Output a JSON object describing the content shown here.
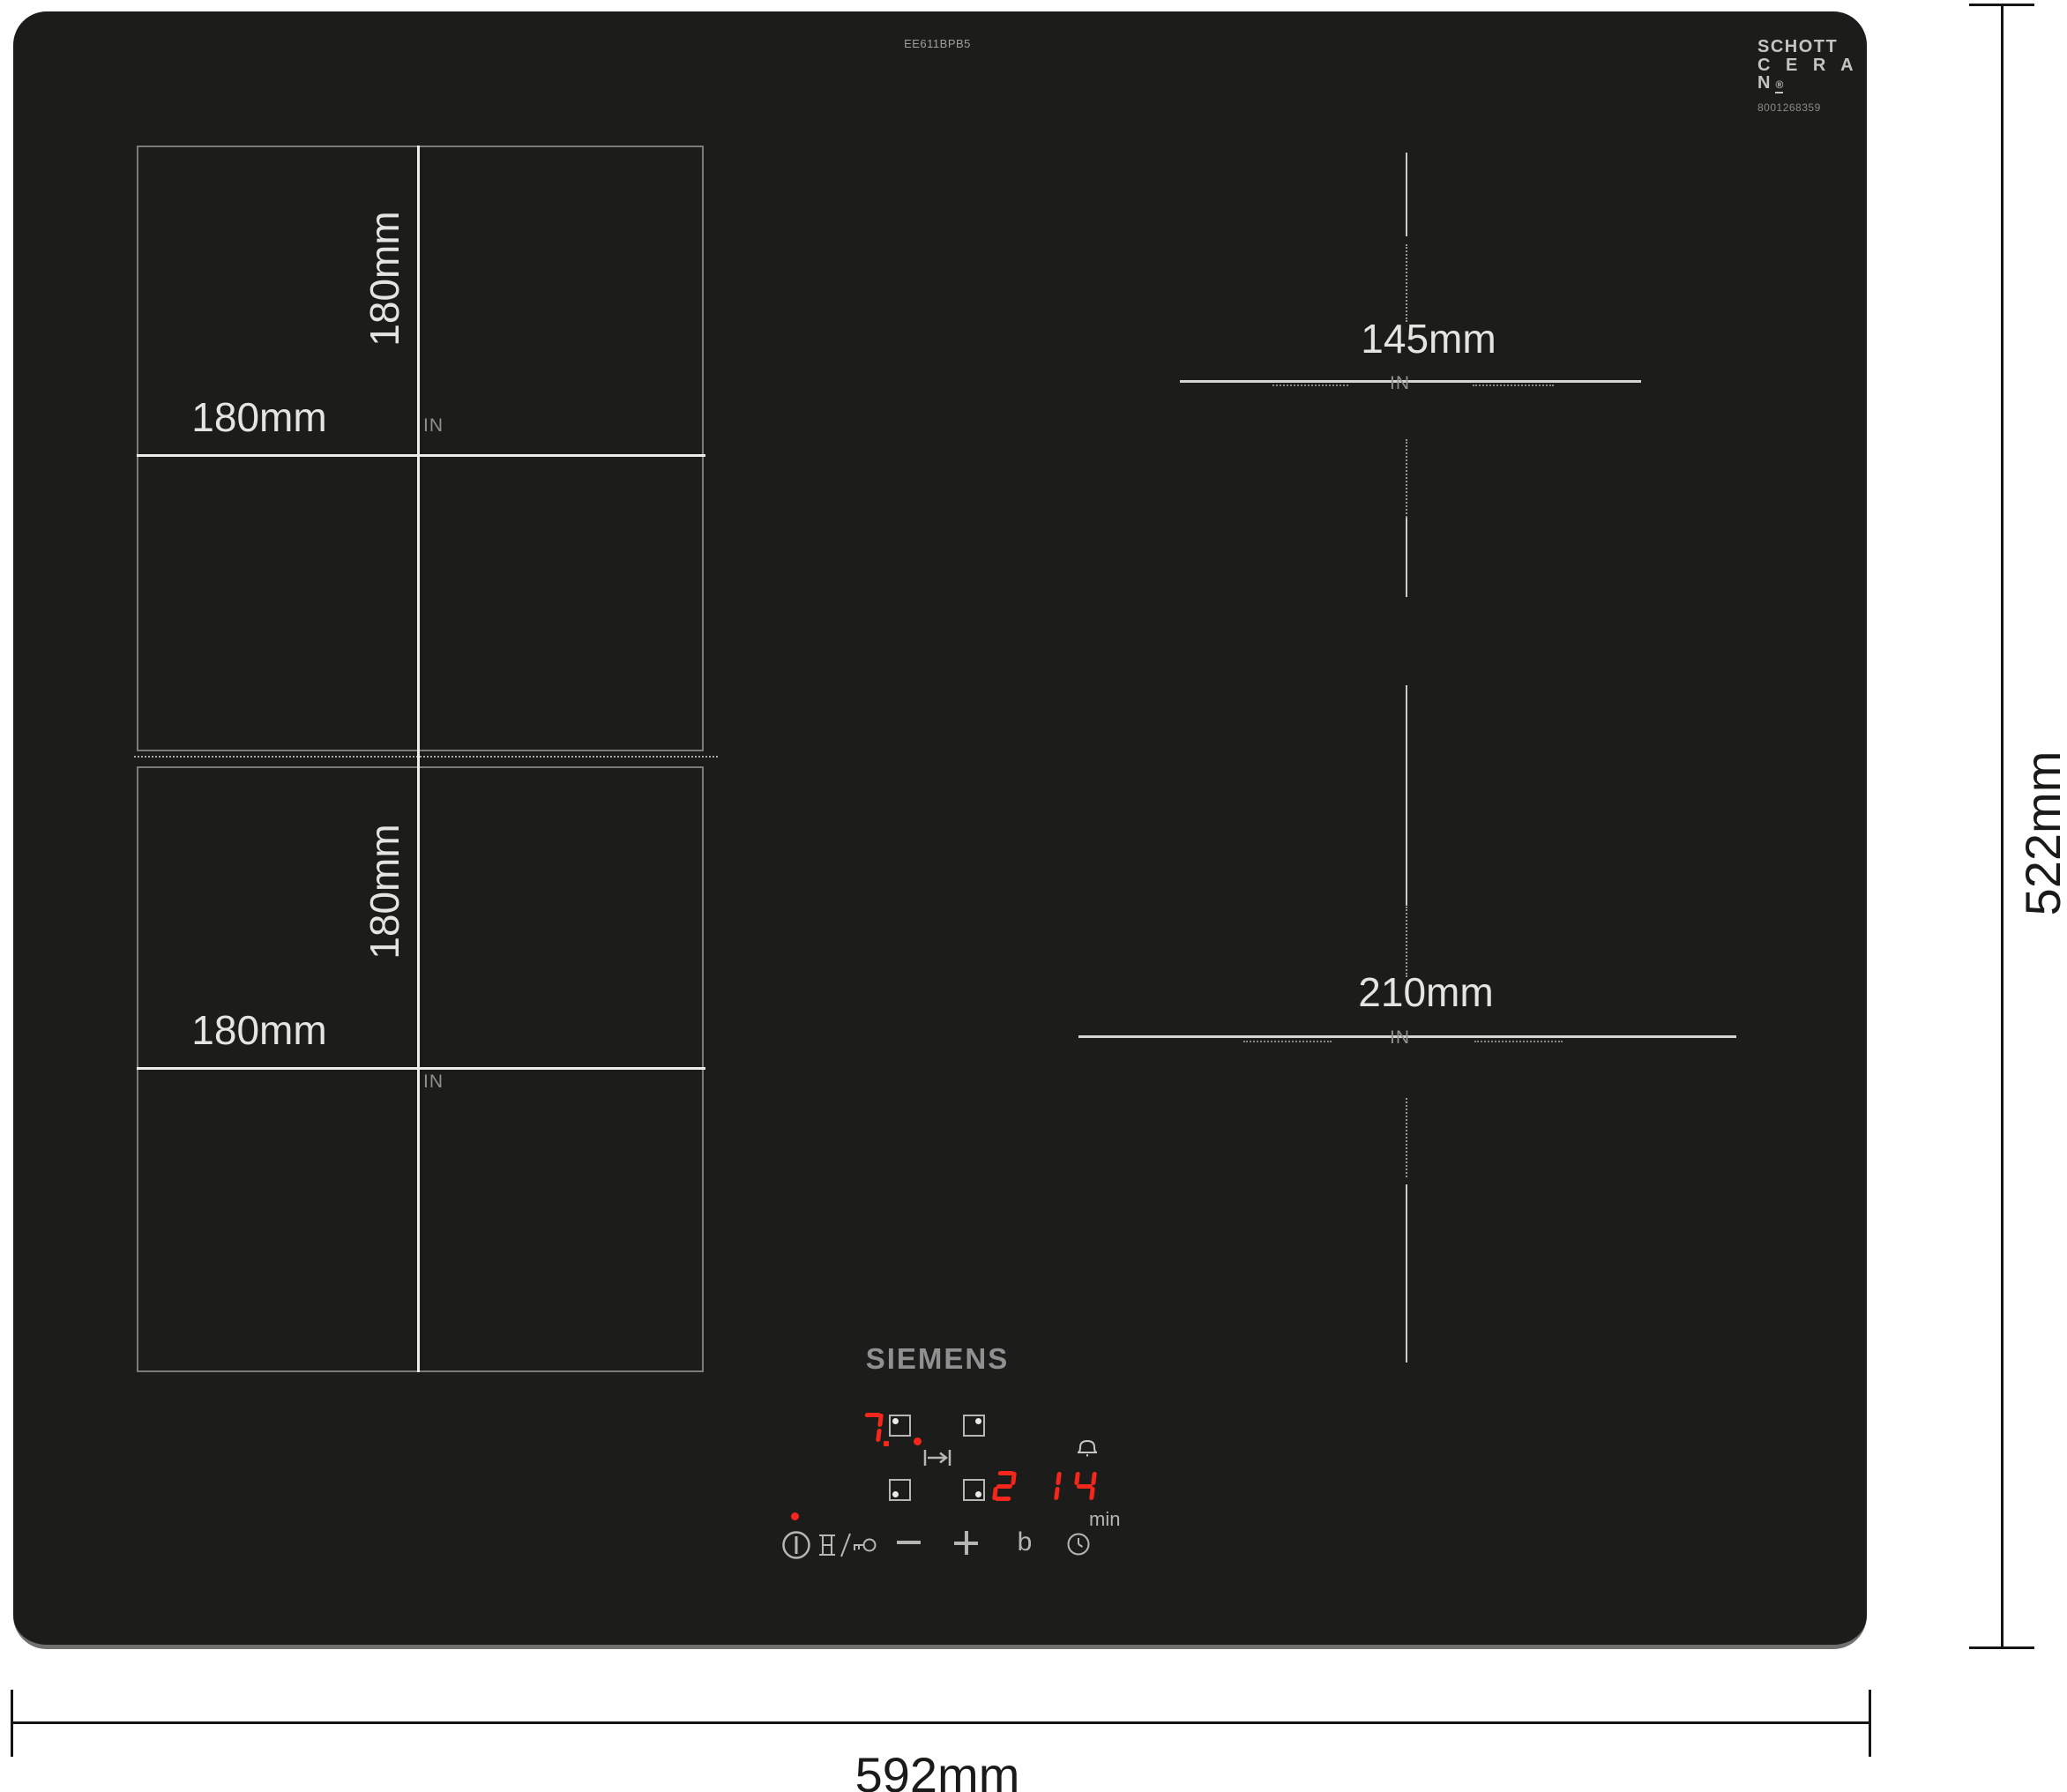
{
  "hob": {
    "model_number": "EE611BPB5",
    "brand": "SIEMENS",
    "surface_color": "#1c1c1a",
    "glass_logo": {
      "line1": "SCHOTT",
      "line2": "C E R A N",
      "registered_mark": "®",
      "serial_code": "8001268359"
    }
  },
  "outer_dimensions": {
    "width_label": "592mm",
    "depth_label": "522mm"
  },
  "zones": {
    "back_left": {
      "width_label": "180mm",
      "height_label": "180mm",
      "induction_mark": "IN"
    },
    "front_left": {
      "width_label": "180mm",
      "height_label": "180mm",
      "induction_mark": "IN"
    },
    "back_right": {
      "diameter_label": "145mm",
      "induction_mark": "IN"
    },
    "front_right": {
      "diameter_label": "210mm",
      "induction_mark": "IN"
    }
  },
  "control_panel": {
    "heat_level_display": "7",
    "timer_zone_display": "2",
    "timer_minutes_display": "14",
    "timer_unit_label": "min",
    "booster_key_label": "b",
    "led_color": "#f3271b",
    "icon_color": "#b6b6b4"
  }
}
